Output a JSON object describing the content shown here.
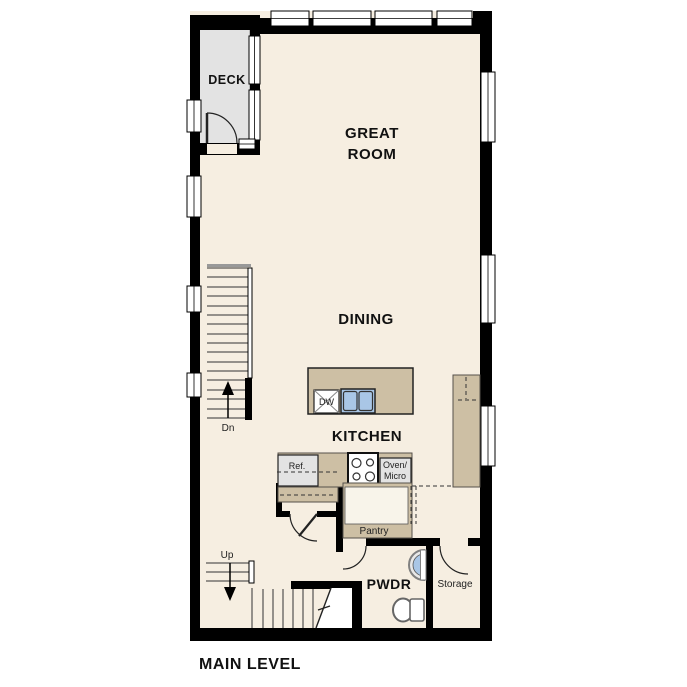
{
  "plan": {
    "title": "MAIN LEVEL",
    "level_type": "floor-plan"
  },
  "colors": {
    "floor": "#f6eee1",
    "deck": "#e3e3e3",
    "counter_tan": "#cdbfa4",
    "sink_blue": "#a9c6e6",
    "wall_black": "#000000",
    "appliance_gray": "#e3e3e3",
    "background": "#ffffff"
  },
  "rooms": {
    "deck": {
      "label": "DECK"
    },
    "great_room": {
      "label_line1": "GREAT",
      "label_line2": "ROOM"
    },
    "dining": {
      "label": "DINING"
    },
    "kitchen": {
      "label": "KITCHEN"
    },
    "pwdr": {
      "label": "PWDR"
    },
    "storage": {
      "label": "Storage"
    },
    "pantry": {
      "label": "Pantry"
    }
  },
  "fixtures": {
    "dishwasher": {
      "label": "DW"
    },
    "refrigerator": {
      "label": "Ref."
    },
    "oven_micro": {
      "label_line1": "Oven/",
      "label_line2": "Micro"
    }
  },
  "stairs": {
    "up": {
      "label": "Up"
    },
    "down": {
      "label": "Dn"
    }
  }
}
